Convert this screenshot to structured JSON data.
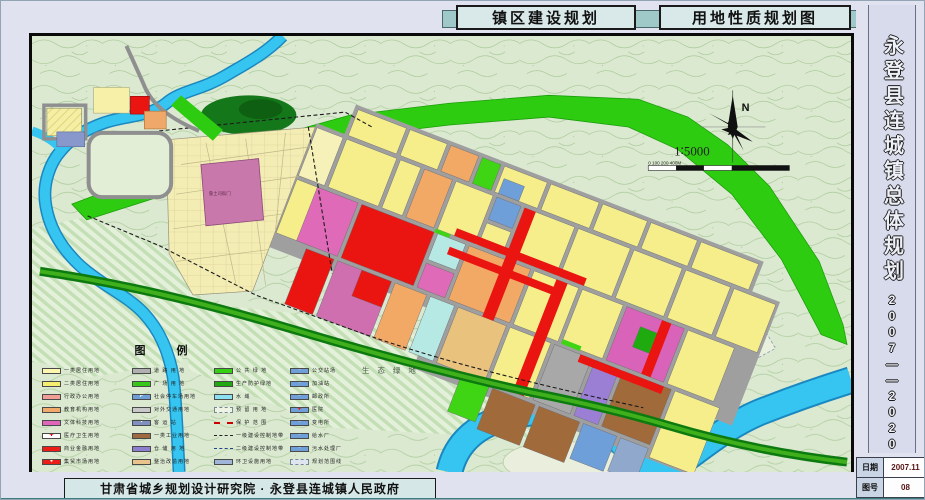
{
  "header": {
    "title_left": "镇区建设规划",
    "title_right": "用地性质规划图"
  },
  "sidebar": {
    "title_vertical": "永登县连城镇总体规划",
    "years": "2007——2020",
    "table": {
      "date_label": "日期",
      "date_value": "2007.11",
      "sheet_label": "图号",
      "sheet_value": "08"
    }
  },
  "footer": {
    "credit": "甘肃省城乡规划设计研究院 · 永登县连城镇人民政府"
  },
  "map": {
    "labels": {
      "eco_green": "生 态 绿 地",
      "heritage": "鲁土司衙门",
      "north": "N",
      "scale_ratio": "1∶5000",
      "scale_ticks": "0  100   200              400M"
    },
    "colors": {
      "topo_background": "#dbe9d1",
      "river": "#36c5f0",
      "public_green": "#2ecc10",
      "residential_yellow": "#f5ee8a",
      "commercial_red": "#ea1410",
      "culture_magenta": "#df6ab8",
      "heritage_mauve": "#c878aa",
      "education_orange": "#f2a966",
      "industry_brown": "#a06a3a",
      "warehouse_purple": "#9b7fd4",
      "utility_blue": "#6f9fd8",
      "medical_cyan": "#b7e9e4",
      "road_gray": "#9f9fa0"
    }
  },
  "legend": {
    "title": "图    例",
    "columns": [
      {
        "items": [
          {
            "label": "一类居住用地",
            "color": "#fdf6b0"
          },
          {
            "label": "二类居住用地",
            "color": "#f6ee6e"
          },
          {
            "label": "行政办公用地",
            "color": "#f09e96"
          },
          {
            "label": "教育机构用地",
            "color": "#f2aa6a"
          },
          {
            "label": "文体科技用地",
            "color": "#df66b8"
          },
          {
            "label": "医疗卫生用地",
            "color": "#ffffff",
            "glyph": "✚",
            "glyph_color": "#dd0000"
          },
          {
            "label": "商业金融用地",
            "color": "#ec1c16"
          },
          {
            "label": "集贸市场用地",
            "color": "#ec1c16",
            "glyph": "●",
            "glyph_color": "#ffffff"
          }
        ]
      },
      {
        "items": [
          {
            "label": "道 路 用 地",
            "color": "#b0b0b0"
          },
          {
            "label": "广 场 用 地",
            "color": "#35c818"
          },
          {
            "label": "社会停车场用地",
            "color": "#6f9fd8",
            "glyph": "P",
            "glyph_color": "#ffffff"
          },
          {
            "label": "对外交通用地",
            "color": "#c8c8c8"
          },
          {
            "label": "客  运  站",
            "color": "#8090c0",
            "glyph": "▪",
            "glyph_color": "#ffffff"
          },
          {
            "label": "一类工业用地",
            "color": "#9e6b41"
          },
          {
            "label": "仓 储 用 地",
            "color": "#8d7fd0"
          },
          {
            "label": "整治改造用地",
            "color": "#e8c48c"
          }
        ]
      },
      {
        "items": [
          {
            "label": "公 共 绿 地",
            "color": "#35d014"
          },
          {
            "label": "生产防护绿地",
            "color": "#1fa80f"
          },
          {
            "label": "水        域",
            "color": "#8ae0f0"
          },
          {
            "label": "预 留 用 地",
            "color": "#edf4e4",
            "style": "dashedbox"
          },
          {
            "label": "保 护 范 围",
            "style": "line"
          },
          {
            "label": "一级建设控制地带",
            "style": "line black"
          },
          {
            "label": "二级建设控制地带",
            "style": "line blue"
          },
          {
            "label": "环卫设施用地",
            "color": "#9fb6d8"
          }
        ]
      },
      {
        "items": [
          {
            "label": "公交站场",
            "color": "#6f9fd8",
            "glyph": "▫",
            "glyph_color": "#ffffff"
          },
          {
            "label": "加油站",
            "color": "#6f9fd8",
            "glyph": "▫",
            "glyph_color": "#ffffff"
          },
          {
            "label": "邮政所",
            "color": "#6f9fd8",
            "glyph": "▫",
            "glyph_color": "#ffffff"
          },
          {
            "label": "医院",
            "color": "#6f9fd8",
            "glyph": "✚",
            "glyph_color": "#dd2222"
          },
          {
            "label": "变电所",
            "color": "#6f9fd8",
            "glyph": "▫",
            "glyph_color": "#ffffff"
          },
          {
            "label": "给水厂",
            "color": "#6f9fd8",
            "glyph": "▫",
            "glyph_color": "#ffffff"
          },
          {
            "label": "污水处理厂",
            "color": "#6f9fd8",
            "glyph": "▫",
            "glyph_color": "#ffffff"
          },
          {
            "label": "规划范围线",
            "color": "#dfe6f0",
            "style": "dashedbox"
          }
        ]
      }
    ]
  }
}
